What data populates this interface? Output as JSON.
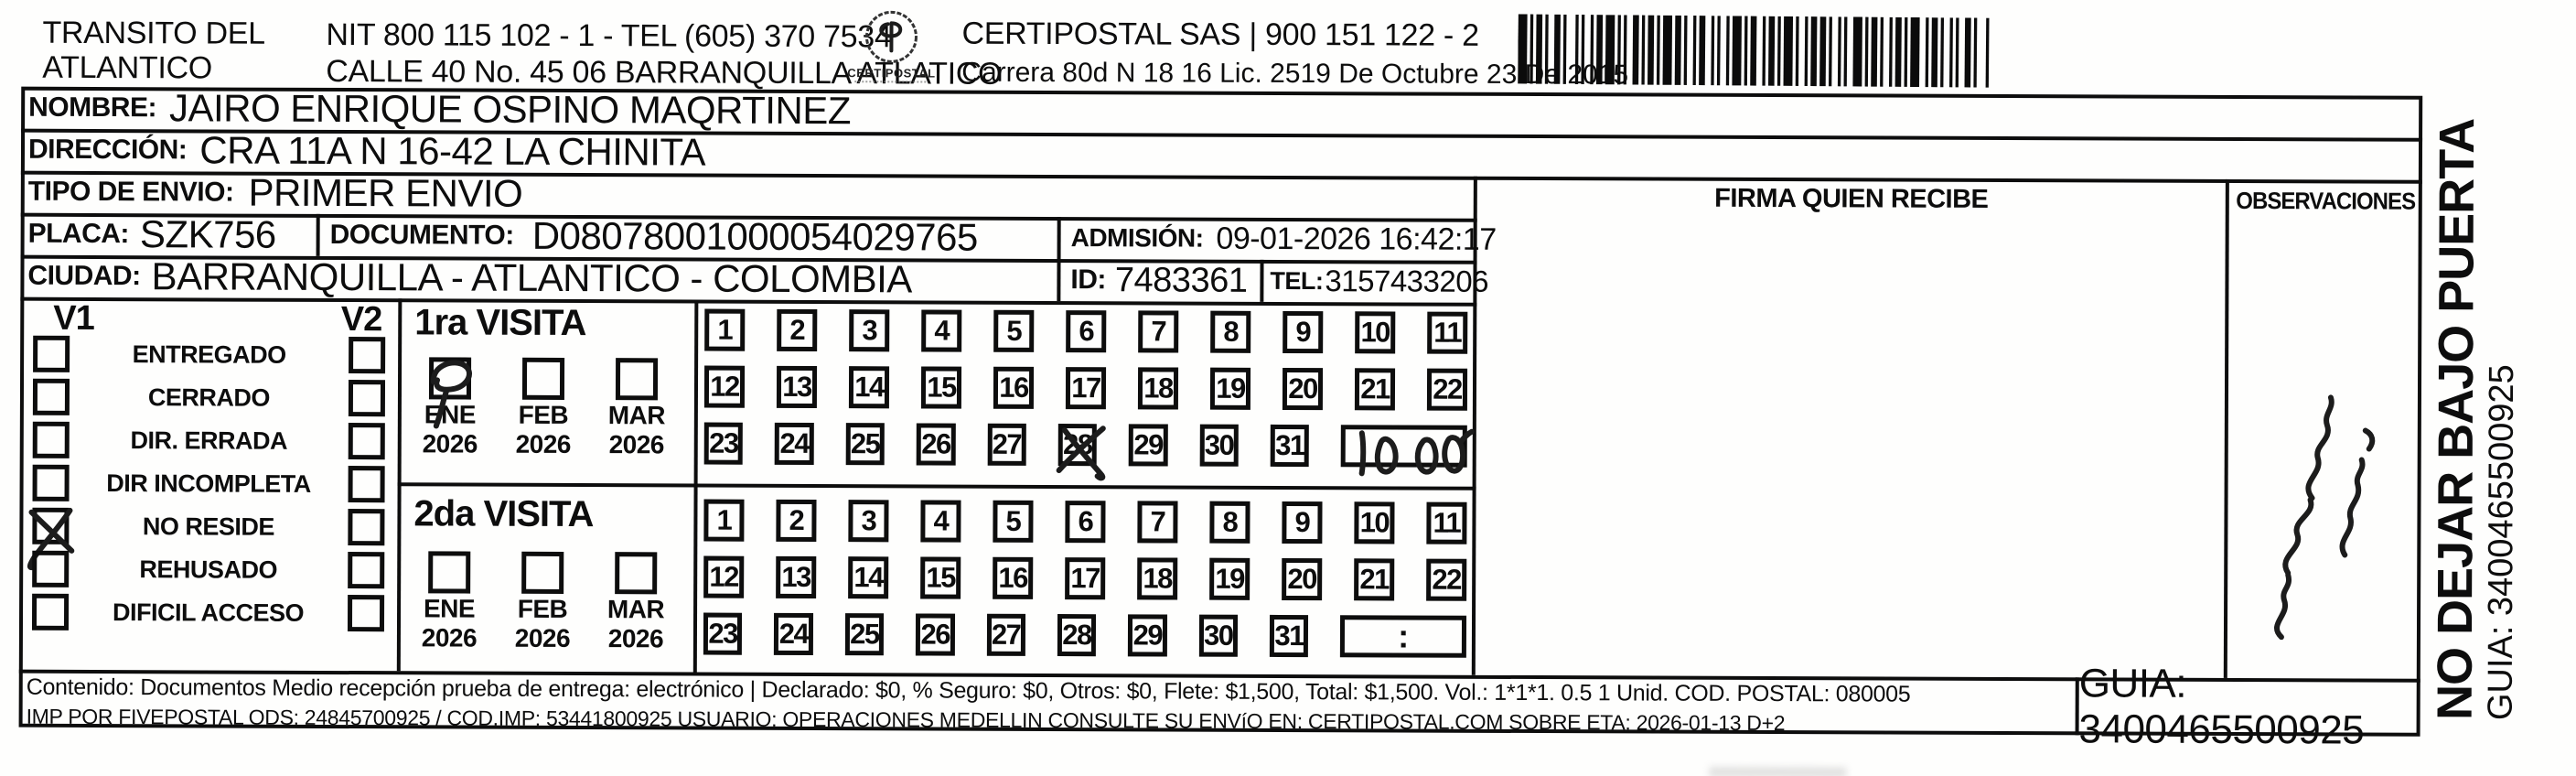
{
  "header": {
    "company_line1": "TRANSITO DEL",
    "company_line2": "ATLANTICO",
    "nit_tel_line": "NIT 800 115 102 - 1 - TEL (605) 370 7534",
    "address_line": "CALLE 40 No. 45 06 BARRANQUILLA ATLATICO",
    "logo_caption": "CERTIPOSTAL",
    "operator_line": "CERTIPOSTAL SAS | 900 151 122 - 2",
    "license_line": "Carrera 80d N 18 16  Lic. 2519 De Octubre 23 De 2015"
  },
  "shipment": {
    "nombre_label": "NOMBRE:",
    "nombre": "JAIRO ENRIQUE OSPINO MAQRTINEZ",
    "direccion_label": "DIRECCIÓN:",
    "direccion": "CRA 11A N 16-42 LA CHINITA",
    "tipo_envio_label": "TIPO DE ENVIO:",
    "tipo_envio": "PRIMER ENVIO",
    "placa_label": "PLACA:",
    "placa": "SZK756",
    "documento_label": "DOCUMENTO:",
    "documento": "D08078001000054029765",
    "admision_label": "ADMISIÓN:",
    "admision": "09-01-2026 16:42:17",
    "ciudad_label": "CIUDAD:",
    "ciudad": "BARRANQUILLA - ATLANTICO - COLOMBIA",
    "id_label": "ID:",
    "id": "7483361",
    "tel_label": "TEL:",
    "tel": "3157433206"
  },
  "delivery_status": {
    "col1_header": "V1",
    "col2_header": "V2",
    "options": [
      "ENTREGADO",
      "CERRADO",
      "DIR. ERRADA",
      "DIR INCOMPLETA",
      "NO RESIDE",
      "REHUSADO",
      "DIFICIL ACCESO"
    ],
    "v1_checked_option": "NO RESIDE"
  },
  "visits": {
    "day_labels": [
      "1",
      "2",
      "3",
      "4",
      "5",
      "6",
      "7",
      "8",
      "9",
      "10",
      "11",
      "12",
      "13",
      "14",
      "15",
      "16",
      "17",
      "18",
      "19",
      "20",
      "21",
      "22",
      "23",
      "24",
      "25",
      "26",
      "27",
      "28",
      "29",
      "30",
      "31"
    ],
    "first": {
      "title": "1ra VISITA",
      "months": [
        {
          "label": "ENE",
          "year": "2026",
          "checked": true
        },
        {
          "label": "FEB",
          "year": "2026",
          "checked": false
        },
        {
          "label": "MAR",
          "year": "2026",
          "checked": false
        }
      ],
      "marked_day": "28",
      "time_note_handwritten": "10:00"
    },
    "second": {
      "title": "2da VISITA",
      "months": [
        {
          "label": "ENE",
          "year": "2026",
          "checked": false
        },
        {
          "label": "FEB",
          "year": "2026",
          "checked": false
        },
        {
          "label": "MAR",
          "year": "2026",
          "checked": false
        }
      ],
      "time_placeholder": ":"
    }
  },
  "signature": {
    "firma_header": "FIRMA QUIEN RECIBE",
    "observaciones_header": "OBSERVACIONES"
  },
  "side_note": {
    "warning": "NO DEJAR BAJO PUERTA",
    "guia": "GUIA: 3400465500925"
  },
  "footer": {
    "line1": "Contenido: Documentos Medio recepción prueba de entrega: electrónico | Declarado: $0, % Seguro: $0, Otros: $0, Flete: $1,500, Total: $1,500. Vol.: 1*1*1. 0.5  1 Unid. COD. POSTAL: 080005",
    "line2": "IMP POR FIVEPOSTAL ODS: 24845700925 / COD.IMP: 53441800925 USUARIO: OPERACIONES MEDELLIN CONSULTE SU ENVíO EN: CERTIPOSTAL.COM SOBRE ETA: 2026-01-13 D+2",
    "guia": "GUIA: 3400465500925"
  }
}
